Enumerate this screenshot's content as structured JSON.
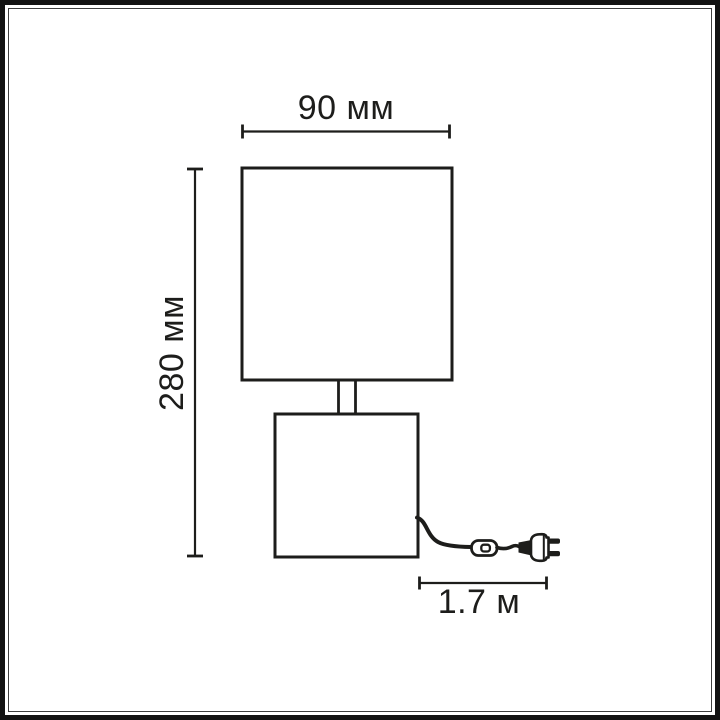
{
  "page": {
    "background_color": "#ffffff",
    "frame_outer_color": "#121212",
    "frame_inner_line_color": "#3f3f3f",
    "line_color": "#1d1d1b"
  },
  "diagram": {
    "type": "dimension_drawing",
    "subject": "table lamp with square shade, square base, power cord with inline switch and plug",
    "labels": {
      "width": "90 мм",
      "height": "280 мм",
      "cord": "1.7 м"
    }
  }
}
